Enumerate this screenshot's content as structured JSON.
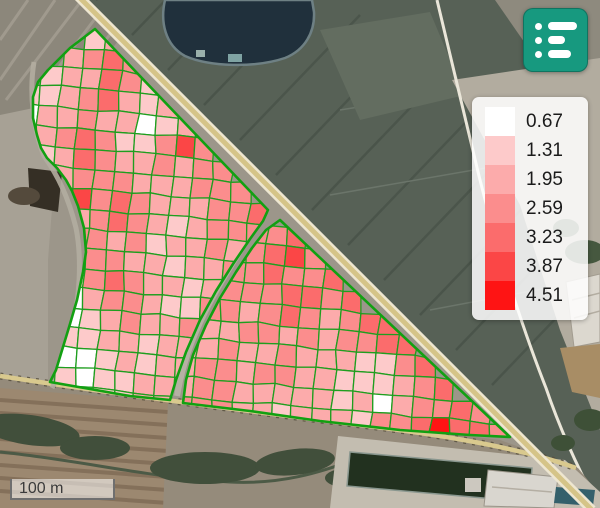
{
  "controls": {
    "menu_button": {
      "icon": "list-icon",
      "color": "#17997f"
    },
    "scale_bar": {
      "label": "100 m"
    }
  },
  "legend": {
    "items": [
      {
        "value": "0.67",
        "color": "#ffffff"
      },
      {
        "value": "1.31",
        "color": "#fdcaca"
      },
      {
        "value": "1.95",
        "color": "#fcabab"
      },
      {
        "value": "2.59",
        "color": "#fb8d8d"
      },
      {
        "value": "3.23",
        "color": "#fb6c6c"
      },
      {
        "value": "3.87",
        "color": "#fb4646"
      },
      {
        "value": "4.51",
        "color": "#fe1414"
      }
    ]
  },
  "field_overlay": {
    "palette": [
      "#ffffff",
      "#fdcaca",
      "#fcabab",
      "#fb8d8d",
      "#fb6c6c",
      "#fb4646",
      "#fe1414"
    ],
    "boundary_color": "#12a012",
    "cell_line_color": "#1f9e1f",
    "grid": {
      "origin": [
        26,
        24
      ],
      "col": [
        19.8,
        1.7
      ],
      "row": [
        -1.7,
        19.8
      ],
      "rows": [
        "0002343000000000000000000000",
        "0034543400000000000000000000",
        "0233542600000000000000000000",
        "2234532340000000000000000000",
        "1334331233000000000000000000",
        "1345422464000000000000000000",
        "2235433434400000000000000000",
        "0234443334440000000000000000",
        "0346454333445000000000000000",
        "0043454323444450000000000000",
        "0024434233434564000000000000",
        "0023443323344544500000000000",
        "0002454332344455450000000000",
        "0001344322443454345500000000",
        "0031234334334434344550000000",
        "0052233233343343332245000000",
        "0021123233443443322234500000",
        "0002122333443333323134454000",
        "0002222334443323332445755400",
        "0000000000333433443445545440"
      ]
    },
    "polygons": {
      "left": [
        [
          95,
          29
        ],
        [
          70,
          48
        ],
        [
          48,
          70
        ],
        [
          38,
          82
        ],
        [
          33,
          97
        ],
        [
          33,
          118
        ],
        [
          37,
          135
        ],
        [
          41,
          148
        ],
        [
          47,
          158
        ],
        [
          57,
          168
        ],
        [
          66,
          180
        ],
        [
          72,
          191
        ],
        [
          78,
          206
        ],
        [
          84,
          228
        ],
        [
          86,
          252
        ],
        [
          83,
          272
        ],
        [
          77,
          300
        ],
        [
          70,
          324
        ],
        [
          63,
          347
        ],
        [
          56,
          370
        ],
        [
          50,
          382
        ],
        [
          90,
          389
        ],
        [
          130,
          396
        ],
        [
          170,
          400
        ],
        [
          176,
          380
        ],
        [
          186,
          352
        ],
        [
          200,
          320
        ],
        [
          216,
          291
        ],
        [
          233,
          264
        ],
        [
          250,
          239
        ],
        [
          263,
          221
        ],
        [
          268,
          210
        ]
      ],
      "right": [
        [
          280,
          220
        ],
        [
          266,
          230
        ],
        [
          252,
          248
        ],
        [
          236,
          272
        ],
        [
          220,
          298
        ],
        [
          206,
          325
        ],
        [
          193,
          355
        ],
        [
          186,
          380
        ],
        [
          183,
          403
        ],
        [
          250,
          411
        ],
        [
          320,
          421
        ],
        [
          400,
          430
        ],
        [
          470,
          435
        ],
        [
          510,
          437
        ]
      ]
    }
  }
}
